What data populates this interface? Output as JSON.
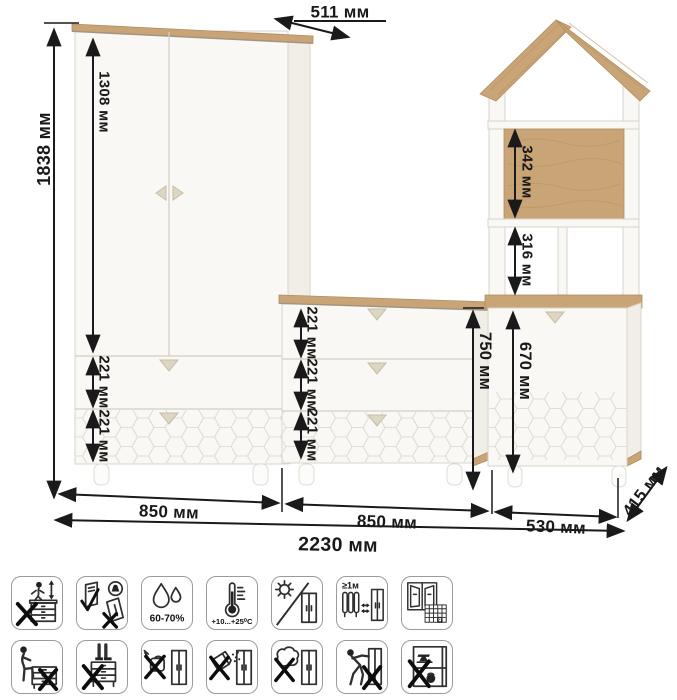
{
  "diagram": {
    "wardrobe": {
      "height_label": "1838 мм",
      "door_height_label": "1308 мм",
      "top_depth_label": "511 мм",
      "drawer1_label": "221 мм",
      "drawer2_label": "221 мм",
      "width_label": "850 мм"
    },
    "chest": {
      "drawer1_label": "221 мм",
      "drawer2_label": "221 мм",
      "drawer3_label": "221 мм",
      "height_label": "750 мм",
      "width_label": "850 мм"
    },
    "tower": {
      "upper_shelf_label": "342 мм",
      "lower_shelf_label": "316 мм",
      "door_height_label": "670 мм",
      "width_label": "530 мм"
    },
    "total_width_label": "2230 мм",
    "depth_label": "415 мм"
  },
  "colors": {
    "wood": "#c9a477",
    "body": "#f9f8f4",
    "dimension_text": "#191919",
    "honeycomb": "#e0ded5"
  },
  "icons": {
    "row1": [
      {
        "name": "no-climbing-on-furniture"
      },
      {
        "name": "no-moving-assembled"
      },
      {
        "name": "humidity-range",
        "label": "60-70%"
      },
      {
        "name": "temperature-range",
        "label": "+10...+25⁰C"
      },
      {
        "name": "no-direct-sunlight"
      },
      {
        "name": "keep-distance-from-heaters",
        "label": "≥1м"
      },
      {
        "name": "ventilate-room",
        "label": "21"
      }
    ],
    "row2": [
      {
        "name": "no-sitting"
      },
      {
        "name": "no-standing"
      },
      {
        "name": "no-pouring-water"
      },
      {
        "name": "no-abrasive-powders"
      },
      {
        "name": "no-wet-cleaning"
      },
      {
        "name": "no-pushing"
      },
      {
        "name": "no-heavy-objects"
      }
    ]
  }
}
